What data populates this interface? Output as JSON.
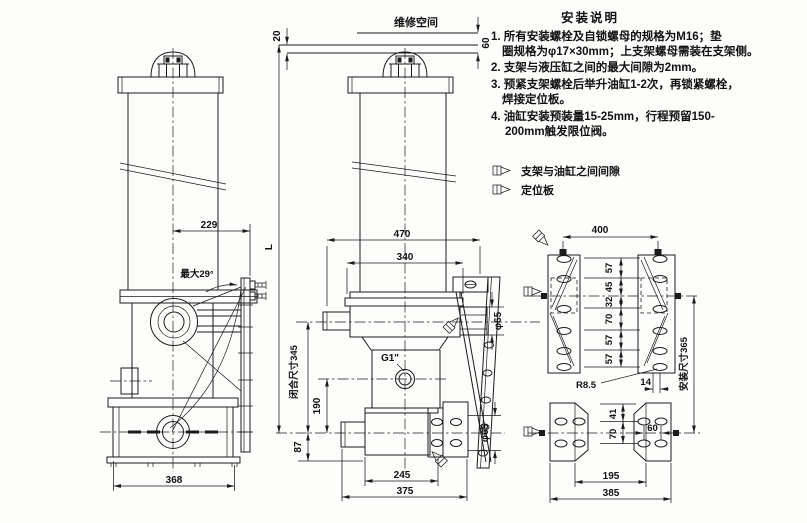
{
  "notes": {
    "title": "安装说明",
    "line1a": "1. 所有安装螺栓及自锁螺母的规格为M16；垫",
    "line1b": "圈规格为φ17×30mm；上支架螺母需装在支架侧。",
    "line2": "2. 支架与液压缸之间的最大间隙为2mm。",
    "line3a": "3. 预紧支架螺栓后举升油缸1-2次，再锁紧螺栓，",
    "line3b": "焊接定位板。",
    "line4a": "4. 油缸安装预装量15-25mm，行程预留150-",
    "line4b": "200mm触发限位阀。",
    "legend_gap": "支架与油缸之间间隙",
    "legend_plate": "定位板"
  },
  "labels": {
    "maintenance_space": "维修空间",
    "max_angle": "最大29°",
    "port": "G1\"",
    "closed_length": "闭合尺寸345",
    "install_length": "安装尺寸365",
    "total_length": "L"
  },
  "dims": {
    "gap20": "20",
    "space60": "60",
    "w229": "229",
    "w368": "368",
    "w470": "470",
    "w340": "340",
    "pin_dia": "φ65",
    "pin_dia_bottom": "φ65",
    "h190": "190",
    "h87": "87",
    "w245": "245",
    "w375": "375",
    "w400": "400",
    "spacings": [
      "57",
      "45",
      "32",
      "70",
      "57",
      "57"
    ],
    "slot_radius": "R8.5",
    "slot_width": "14",
    "p41": "41",
    "p70": "70",
    "p60": "60",
    "p195": "195",
    "p385": "385"
  }
}
